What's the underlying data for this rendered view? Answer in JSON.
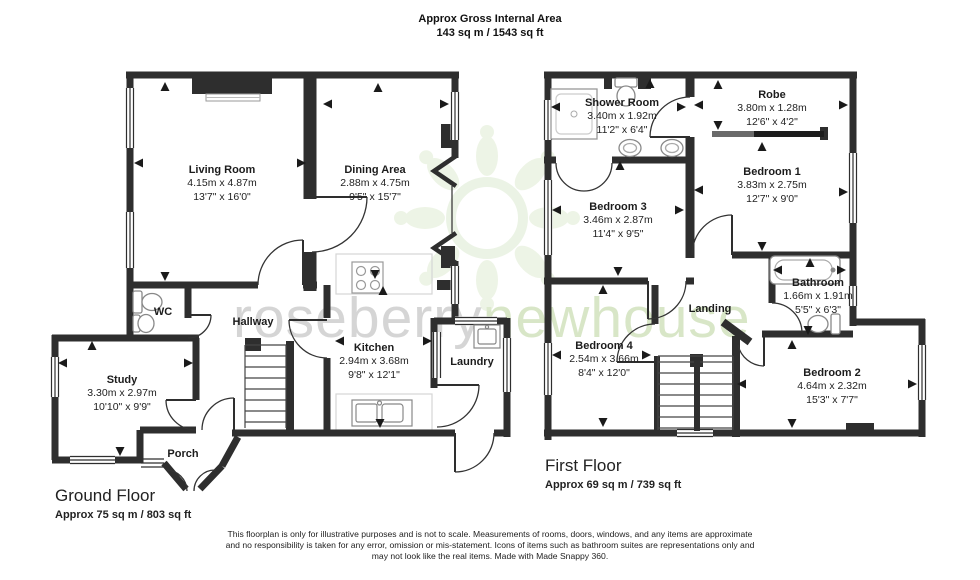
{
  "title": {
    "line1": "Approx Gross Internal Area",
    "line2": "143 sq m / 1543 sq ft"
  },
  "watermark": {
    "part1": "roseberry",
    "part2": "newhouse"
  },
  "floors": {
    "ground": {
      "name": "Ground Floor",
      "area": "Approx 75 sq m / 803 sq ft",
      "rooms": {
        "living": {
          "name": "Living Room",
          "metric": "4.15m x 4.87m",
          "imperial": "13'7\" x 16'0\""
        },
        "dining": {
          "name": "Dining Area",
          "metric": "2.88m x 4.75m",
          "imperial": "9'5\" x 15'7\""
        },
        "kitchen": {
          "name": "Kitchen",
          "metric": "2.94m x 3.68m",
          "imperial": "9'8\" x 12'1\""
        },
        "study": {
          "name": "Study",
          "metric": "3.30m x 2.97m",
          "imperial": "10'10\" x 9'9\""
        },
        "hallway": {
          "name": "Hallway"
        },
        "laundry": {
          "name": "Laundry"
        },
        "wc": {
          "name": "WC"
        },
        "porch": {
          "name": "Porch"
        }
      }
    },
    "first": {
      "name": "First Floor",
      "area": "Approx 69 sq m / 739 sq ft",
      "rooms": {
        "shower": {
          "name": "Shower Room",
          "metric": "3.40m x 1.92m",
          "imperial": "11'2\" x 6'4\""
        },
        "robe": {
          "name": "Robe",
          "metric": "3.80m x 1.28m",
          "imperial": "12'6\" x 4'2\""
        },
        "bed1": {
          "name": "Bedroom 1",
          "metric": "3.83m x 2.75m",
          "imperial": "12'7\" x 9'0\""
        },
        "bed3": {
          "name": "Bedroom 3",
          "metric": "3.46m x 2.87m",
          "imperial": "11'4\" x 9'5\""
        },
        "bathroom": {
          "name": "Bathroom",
          "metric": "1.66m x 1.91m",
          "imperial": "5'5\" x 6'3\""
        },
        "landing": {
          "name": "Landing"
        },
        "bed4": {
          "name": "Bedroom 4",
          "metric": "2.54m x 3.66m",
          "imperial": "8'4\" x 12'0\""
        },
        "bed2": {
          "name": "Bedroom 2",
          "metric": "4.64m x 2.32m",
          "imperial": "15'3\" x 7'7\""
        }
      }
    }
  },
  "disclaimer": {
    "line1": "This floorplan is only for illustrative purposes and is not to scale. Measurements of rooms, doors, windows, and any items are approximate",
    "line2": "and no responsibility is taken for any error, omission or mis-statement. Icons of items such as bathroom suites are representations only and",
    "line3": "may not look like the real items. Made with Made Snappy 360."
  },
  "colors": {
    "wall": "#2e2e2e",
    "watermark_green": "#cfe0ba",
    "watermark_gray": "#c7c7c7"
  }
}
